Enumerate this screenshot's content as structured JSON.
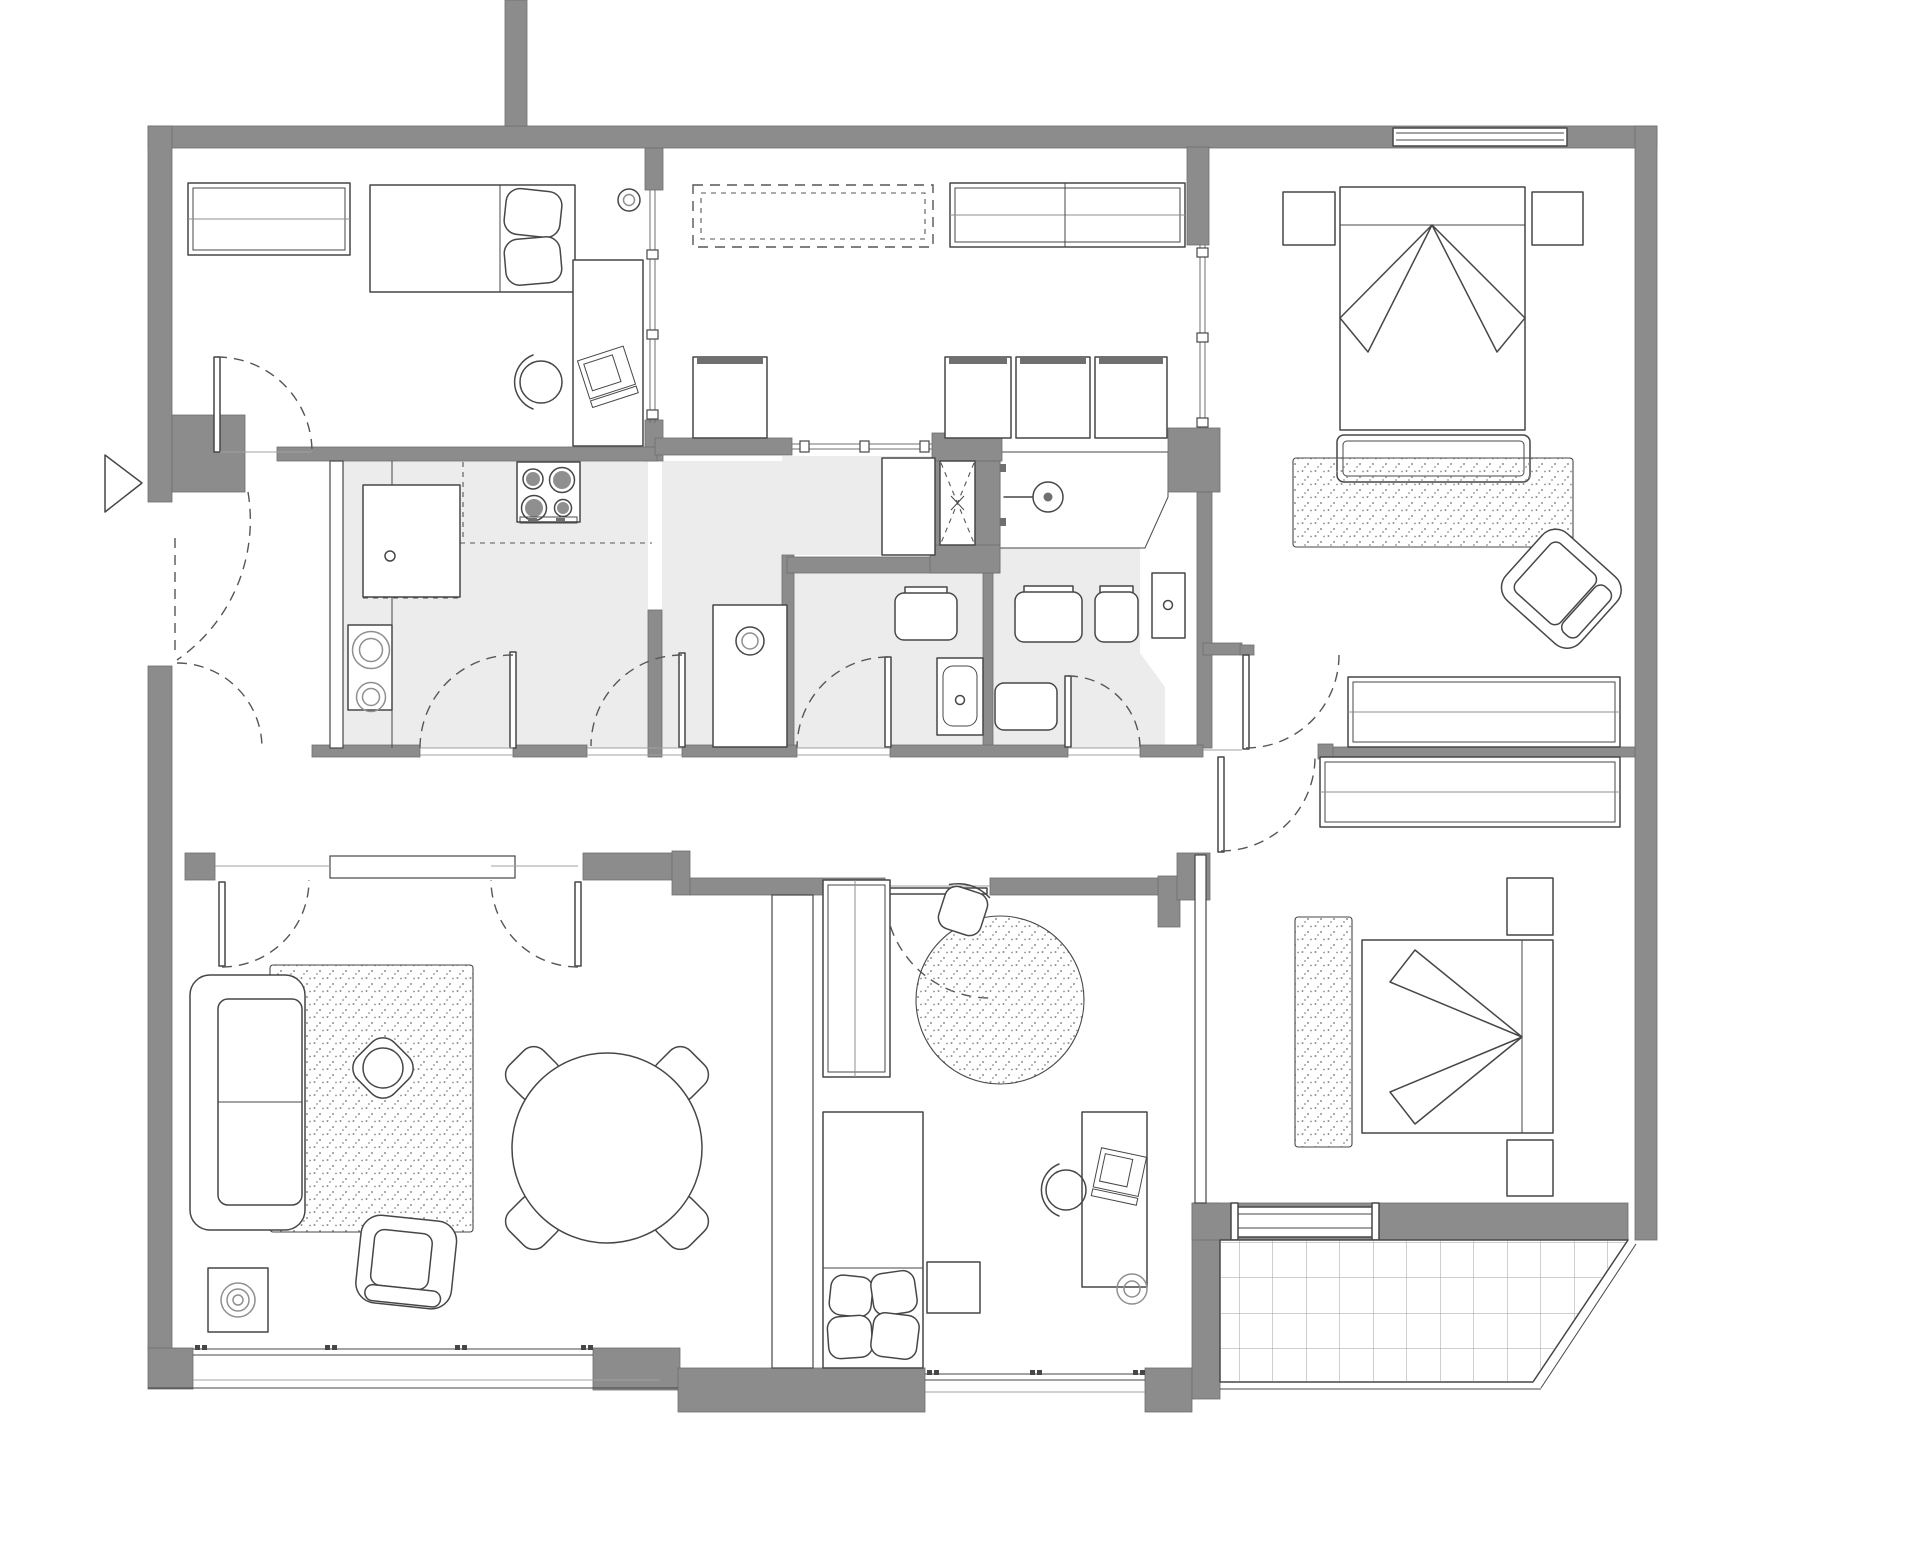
{
  "title": "Apartment floor plan — top view architectural drawing",
  "colors": {
    "wall": "#8c8c8c",
    "wall_edge": "#6e6e6e",
    "line": "#474747",
    "line_light": "#8f8f8f",
    "floor": "#ececec",
    "stripe": "#bdbdbd",
    "dot": "#8f8f8f",
    "grid": "#9f9f9f",
    "hatch": "#8f8f8f",
    "dash": "#565656",
    "white": "#ffffff"
  },
  "rooms": [
    {
      "id": "bedroom-1",
      "label": "bedroom with single bed and desk"
    },
    {
      "id": "dressing-room",
      "label": "dressing room with wardrobes and seat boxes"
    },
    {
      "id": "master-bedroom",
      "label": "master bedroom with double bed"
    },
    {
      "id": "kitchen",
      "label": "kitchen with hob and sink units"
    },
    {
      "id": "laundry",
      "label": "utility room with washer column"
    },
    {
      "id": "bathroom-1",
      "label": "toilet room with sink"
    },
    {
      "id": "bathroom-2",
      "label": "shower bathroom"
    },
    {
      "id": "hallway",
      "label": "entrance hall and corridor"
    },
    {
      "id": "living-room",
      "label": "living room with sofa and dining table"
    },
    {
      "id": "kids-room",
      "label": "kids room with bed, desk and round rug"
    },
    {
      "id": "bedroom-3",
      "label": "bedroom with double bed and wardrobes"
    },
    {
      "id": "terrace",
      "label": "tiled terrace"
    }
  ],
  "furniture": [
    "wardrobe-hatched",
    "overhead-cabinet-dashed",
    "single-bed",
    "double-bed",
    "desk-with-laptop",
    "desk-chair",
    "nightstand",
    "bench",
    "rug-rect",
    "rug-round",
    "sofa",
    "armchair",
    "coffee-table",
    "dining-table",
    "dining-chair",
    "plant-side-table",
    "seat-box",
    "stove-4-burners",
    "kitchen-sink-unit",
    "appliance-rings",
    "washing-machine",
    "vanity-sink",
    "toilet",
    "shower-head",
    "duct-shaft",
    "entrance-arrow",
    "door-swing",
    "glass-partition",
    "window",
    "terrace-grid"
  ]
}
